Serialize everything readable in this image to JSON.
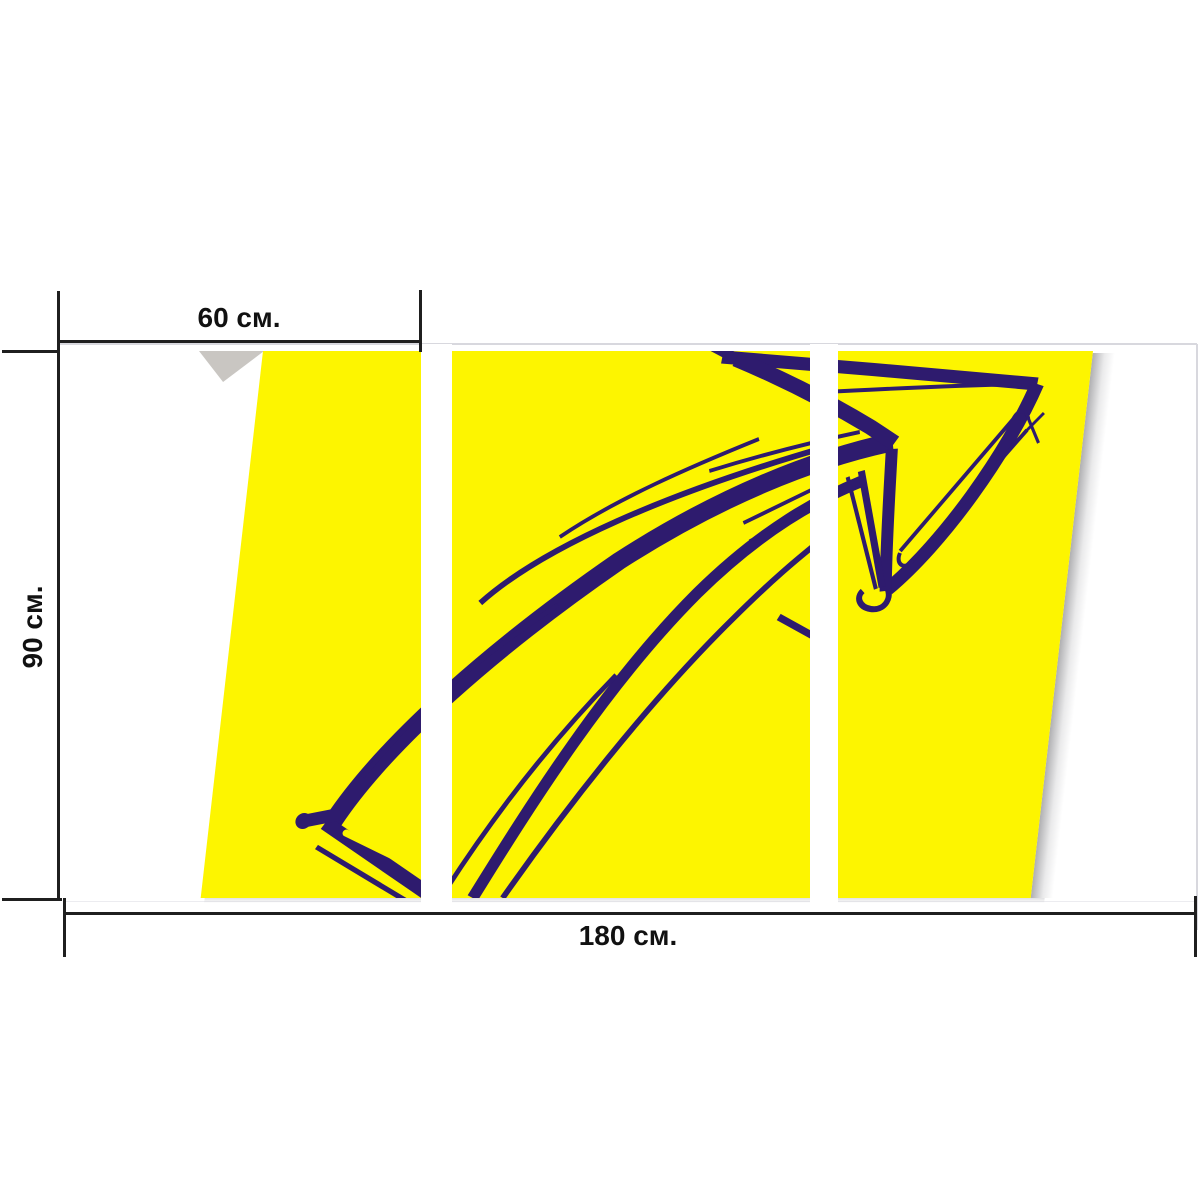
{
  "labels": {
    "panel_width": "60 см.",
    "height": "90 см.",
    "total_width": "180 см."
  },
  "artwork": {
    "icon": "arrow-sketch",
    "panel_count": 3
  },
  "colors": {
    "canvas_yellow": "#FDF500",
    "arrow_ink": "#2E1B6E",
    "dimension_line": "#1F1F1F",
    "label_text": "#111111",
    "fold_shadow": "#C9C6C2",
    "edge_faint": "#D8D8DE"
  }
}
